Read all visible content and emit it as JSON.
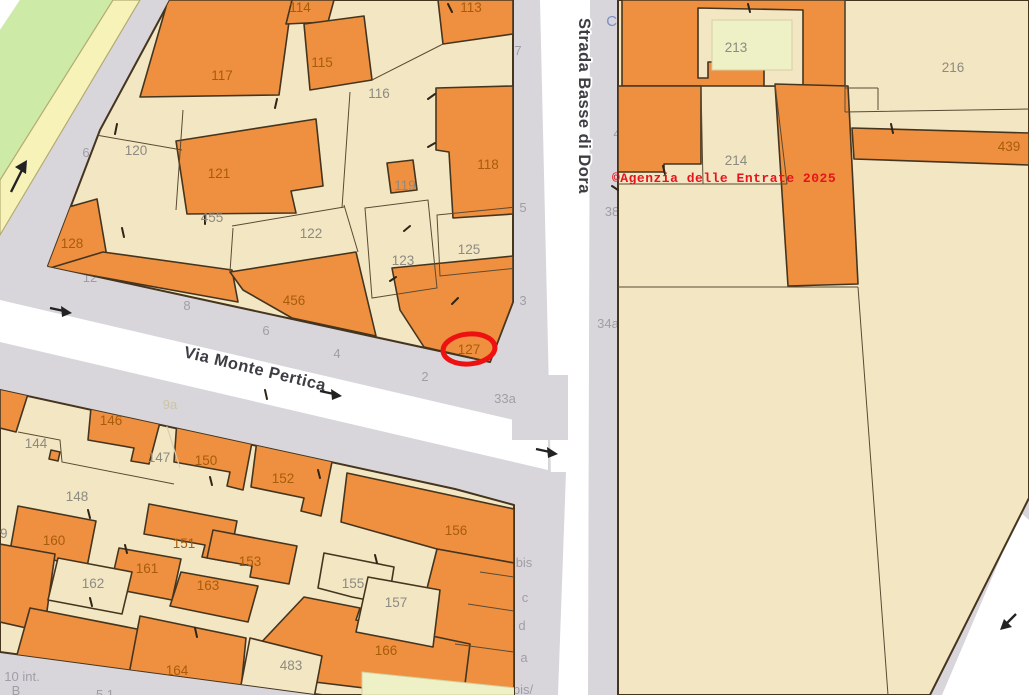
{
  "map": {
    "source_note": "cadastral parcel map",
    "copyright": "©Agenzia delle Entrate 2025",
    "highlighted_parcel": "127",
    "streets": {
      "vertical": "Strada Basse di Dora",
      "diagonal": "Via Monte Pertica",
      "partial_blue": "Cou"
    },
    "colors": {
      "parcel_orange": "#ee9040",
      "parcel_beige": "#f3e6c3",
      "courtyard_pale": "#eef0c6",
      "road_white": "#ffffff",
      "background_gray": "#d9d6db",
      "park_green": "#cdeba6",
      "road_yellow": "#f6f2b8",
      "highlight_red": "#ee1111",
      "copyright_red": "#e8131c"
    },
    "labels": [
      {
        "t": "7",
        "x": 518,
        "y": 55,
        "c": "s",
        "l": "u",
        "n": "street-number-7"
      },
      {
        "t": "5",
        "x": 523,
        "y": 212,
        "c": "s",
        "l": "u",
        "n": "street-number-5"
      },
      {
        "t": "3",
        "x": 523,
        "y": 305,
        "c": "s",
        "l": "u",
        "n": "street-number-3"
      },
      {
        "t": "4",
        "x": 617,
        "y": 138,
        "c": "s",
        "l": "u",
        "n": "street-number-4"
      },
      {
        "t": "38",
        "x": 612,
        "y": 216,
        "c": "s",
        "l": "u",
        "n": "street-number-38"
      },
      {
        "t": "34a",
        "x": 608,
        "y": 328,
        "c": "s",
        "l": "u",
        "n": "street-number-34a"
      },
      {
        "t": "Cou",
        "x": 620,
        "y": 26,
        "c": "blue",
        "l": "u",
        "n": "street-label-partial"
      },
      {
        "t": "bis",
        "x": 524,
        "y": 567,
        "c": "s",
        "l": "u",
        "n": "address-suffix-bis"
      },
      {
        "t": "c",
        "x": 525,
        "y": 602,
        "c": "s",
        "l": "u",
        "n": "address-suffix-c"
      },
      {
        "t": "d",
        "x": 522,
        "y": 630,
        "c": "s",
        "l": "u",
        "n": "address-suffix-d"
      },
      {
        "t": "a",
        "x": 524,
        "y": 662,
        "c": "s",
        "l": "u",
        "n": "address-suffix-a"
      },
      {
        "t": "bis/",
        "x": 523,
        "y": 694,
        "c": "s",
        "l": "u",
        "n": "address-suffix-bis2"
      },
      {
        "t": "27",
        "x": 500,
        "y": 694,
        "c": "fo",
        "l": "u",
        "n": "address-number-27"
      },
      {
        "t": "33a",
        "x": 505,
        "y": 403,
        "c": "s",
        "l": "u",
        "n": "street-number-33a"
      },
      {
        "t": "2",
        "x": 425,
        "y": 381,
        "c": "s",
        "l": "u",
        "n": "street-number-2"
      },
      {
        "t": "4",
        "x": 337,
        "y": 358,
        "c": "s",
        "l": "u",
        "n": "street-number-4b"
      },
      {
        "t": "6",
        "x": 266,
        "y": 335,
        "c": "s",
        "l": "u",
        "n": "street-number-6"
      },
      {
        "t": "8",
        "x": 187,
        "y": 310,
        "c": "s",
        "l": "u",
        "n": "street-number-8"
      },
      {
        "t": "12",
        "x": 90,
        "y": 282,
        "c": "s",
        "l": "u",
        "n": "street-number-12"
      },
      {
        "t": "6",
        "x": 86,
        "y": 157,
        "c": "s",
        "l": "u",
        "n": "street-number-6b"
      },
      {
        "t": "10 int.",
        "x": 22,
        "y": 681,
        "c": "s",
        "l": "u",
        "n": "street-number-10int"
      },
      {
        "t": "B",
        "x": 16,
        "y": 695,
        "c": "s",
        "l": "u",
        "n": "street-number-B"
      },
      {
        "t": "5 1",
        "x": 105,
        "y": 699,
        "c": "s",
        "l": "u",
        "n": "street-number-partial"
      },
      {
        "t": "114",
        "x": 300,
        "y": 12,
        "c": "o",
        "l": "t",
        "n": "parcel-label-114"
      },
      {
        "t": "113",
        "x": 471,
        "y": 12,
        "c": "o",
        "l": "t",
        "n": "parcel-label-113"
      },
      {
        "t": "117",
        "x": 222,
        "y": 80,
        "c": "o",
        "l": "t",
        "n": "parcel-label-117"
      },
      {
        "t": "115",
        "x": 322,
        "y": 67,
        "c": "o",
        "l": "t",
        "n": "parcel-label-115"
      },
      {
        "t": "118",
        "x": 488,
        "y": 169,
        "c": "o",
        "l": "t",
        "n": "parcel-label-118"
      },
      {
        "t": "121",
        "x": 219,
        "y": 178,
        "c": "o",
        "l": "t",
        "n": "parcel-label-121"
      },
      {
        "t": "128",
        "x": 72,
        "y": 248,
        "c": "o",
        "l": "t",
        "n": "parcel-label-128"
      },
      {
        "t": "456",
        "x": 294,
        "y": 305,
        "c": "o",
        "l": "t",
        "n": "parcel-label-456"
      },
      {
        "t": "127",
        "x": 469,
        "y": 354,
        "c": "o",
        "l": "t",
        "n": "parcel-label-127"
      },
      {
        "t": "146",
        "x": 111,
        "y": 425,
        "c": "o",
        "l": "t",
        "n": "parcel-label-146"
      },
      {
        "t": "150",
        "x": 206,
        "y": 465,
        "c": "o",
        "l": "t",
        "n": "parcel-label-150"
      },
      {
        "t": "152",
        "x": 283,
        "y": 483,
        "c": "o",
        "l": "t",
        "n": "parcel-label-152"
      },
      {
        "t": "156",
        "x": 456,
        "y": 535,
        "c": "o",
        "l": "t",
        "n": "parcel-label-156"
      },
      {
        "t": "160",
        "x": 54,
        "y": 545,
        "c": "o",
        "l": "t",
        "n": "parcel-label-160"
      },
      {
        "t": "151",
        "x": 184,
        "y": 548,
        "c": "o",
        "l": "t",
        "n": "parcel-label-151"
      },
      {
        "t": "161",
        "x": 147,
        "y": 573,
        "c": "o",
        "l": "t",
        "n": "parcel-label-161"
      },
      {
        "t": "153",
        "x": 250,
        "y": 566,
        "c": "o",
        "l": "t",
        "n": "parcel-label-153"
      },
      {
        "t": "163",
        "x": 208,
        "y": 590,
        "c": "o",
        "l": "t",
        "n": "parcel-label-163"
      },
      {
        "t": "164",
        "x": 177,
        "y": 675,
        "c": "o",
        "l": "t",
        "n": "parcel-label-164"
      },
      {
        "t": "166",
        "x": 386,
        "y": 655,
        "c": "o",
        "l": "t",
        "n": "parcel-label-166"
      },
      {
        "t": "439",
        "x": 1009,
        "y": 151,
        "c": "o",
        "l": "t",
        "n": "parcel-label-439"
      },
      {
        "t": "116",
        "x": 379,
        "y": 98,
        "c": "g",
        "l": "t",
        "n": "parcel-label-116"
      },
      {
        "t": "120",
        "x": 136,
        "y": 155,
        "c": "g",
        "l": "t",
        "n": "parcel-label-120"
      },
      {
        "t": "455",
        "x": 212,
        "y": 222,
        "c": "g",
        "l": "t",
        "n": "parcel-label-455"
      },
      {
        "t": "122",
        "x": 311,
        "y": 238,
        "c": "g",
        "l": "t",
        "n": "parcel-label-122"
      },
      {
        "t": "119",
        "x": 405,
        "y": 190,
        "c": "g",
        "l": "t",
        "n": "parcel-label-119"
      },
      {
        "t": "123",
        "x": 403,
        "y": 265,
        "c": "g",
        "l": "t",
        "n": "parcel-label-123"
      },
      {
        "t": "125",
        "x": 469,
        "y": 254,
        "c": "g",
        "l": "t",
        "n": "parcel-label-125"
      },
      {
        "t": "213",
        "x": 736,
        "y": 52,
        "c": "g",
        "l": "t",
        "n": "parcel-label-213"
      },
      {
        "t": "214",
        "x": 736,
        "y": 165,
        "c": "g",
        "l": "t",
        "n": "parcel-label-214"
      },
      {
        "t": "216",
        "x": 953,
        "y": 72,
        "c": "g",
        "l": "t",
        "n": "parcel-label-216"
      },
      {
        "t": "144",
        "x": 36,
        "y": 448,
        "c": "g",
        "l": "t",
        "n": "parcel-label-144"
      },
      {
        "t": "147",
        "x": 159,
        "y": 462,
        "c": "g",
        "l": "t",
        "n": "parcel-label-147"
      },
      {
        "t": "148",
        "x": 77,
        "y": 501,
        "c": "g",
        "l": "t",
        "n": "parcel-label-148"
      },
      {
        "t": "155",
        "x": 353,
        "y": 588,
        "c": "g",
        "l": "t",
        "n": "parcel-label-155"
      },
      {
        "t": "157",
        "x": 396,
        "y": 607,
        "c": "g",
        "l": "t",
        "n": "parcel-label-157"
      },
      {
        "t": "162",
        "x": 93,
        "y": 588,
        "c": "g",
        "l": "t",
        "n": "parcel-label-162"
      },
      {
        "t": "483",
        "x": 291,
        "y": 670,
        "c": "g",
        "l": "t",
        "n": "parcel-label-483"
      },
      {
        "t": "69",
        "x": 0,
        "y": 538,
        "c": "g",
        "l": "t",
        "n": "parcel-label-69"
      },
      {
        "t": "9a",
        "x": 170,
        "y": 409,
        "c": "f",
        "l": "t",
        "n": "courtyard-label-9a"
      }
    ]
  }
}
